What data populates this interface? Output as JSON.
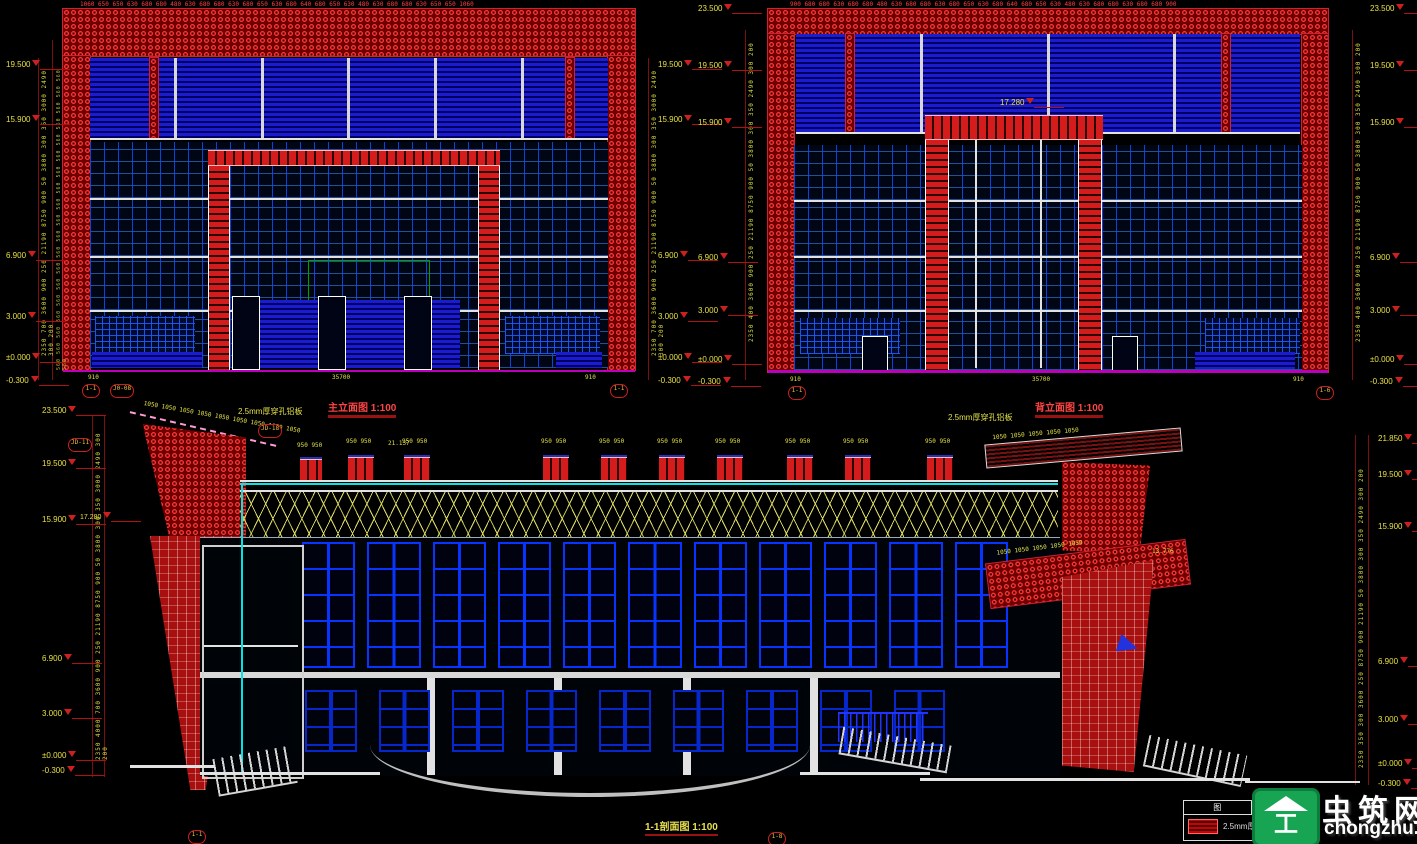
{
  "colors": {
    "background": "#000000",
    "cad_red": "#d41c1c",
    "cad_blue": "#1b1bd0",
    "window_blue": "#0735ff",
    "dim_red": "#ff4040",
    "dim_yellow": "#e0e048",
    "cyan": "#00e5e5",
    "magenta_base": "#bb00bb",
    "truss_yellow": "#d8d860",
    "watermark_green": "#17a554"
  },
  "titles": {
    "front_elevation": "主立面图",
    "front_scale": "1:100",
    "rear_elevation": "背立面图",
    "rear_scale": "1:100",
    "section": "1-1剖面图",
    "section_scale": "1:100"
  },
  "notes": {
    "perforated_panel": "2.5mm厚穿孔铝板"
  },
  "front_elev": {
    "top_dims": "1060 650 650 630 680 680 480 630 680 680 630 680 650 630 680 640 680 650 630 480 630 680 680 630 650 650 1060",
    "side_dims": "2350 700 3600 900 250 21190 8750 900 50 3800 300 350 3000 2490 300 200",
    "side_small_dims": "560 560 560 560 560 560 560 560 560 560 560 560 560 560 560 560 560 560 560 560",
    "levels": [
      "19.500",
      "15.900",
      "6.900",
      "3.000",
      "±0.000",
      "-0.300"
    ],
    "bottom_left": "910",
    "bottom_mid": "35700",
    "bottom_right": "910",
    "axis_a": "1-1",
    "axis_b": "1-1",
    "detail_a": "J0-08"
  },
  "rear_elev": {
    "top_dims": "900 680 680 630 680 680 480 630 680 680 630 680 650 630 680 640 680 650 630 480 630 680 680 630 680 680 900",
    "side_dims": "2350 400 3600 900 250 21190 8750 900 50 3800 300 350 2490 300 200",
    "levels": [
      "23.500",
      "19.500",
      "15.900",
      "6.900",
      "3.000",
      "±0.000",
      "-0.300"
    ],
    "mid_level": "17.280",
    "bottom_left": "910",
    "bottom_mid": "35700",
    "bottom_right": "910",
    "axis_a": "1-1",
    "axis_b": "1-6"
  },
  "section": {
    "levels_left": [
      "23.500",
      "19.500",
      "15.900",
      "6.900",
      "3.000",
      "±0.000",
      "-0.300"
    ],
    "levels_right": [
      "21.850",
      "19.500",
      "15.900",
      "6.900",
      "3.000",
      "±0.000",
      "-0.300"
    ],
    "side_dims_left": "2350 4000 700 3600 900 250 21190 8750 900 50 3800 300 350 3000 2490 300 200",
    "side_dims_right": "2350 350 300 3600 250 8750 900 21190 50 3800 300 350 2490 300 200",
    "slope_dims": "1050 1050 1050 1050 1050 1050 1050 1050 1050",
    "slope_dims2": "1050 1050 1050 1050 1050",
    "monitor_dim": "950 950",
    "mark_17280": "17.280",
    "mark_13776": "13.776",
    "mark_21137": "21.137",
    "detail_a": "JD-18",
    "detail_b": "JD-11",
    "axis_a": "1-1",
    "axis_b": "1-8"
  },
  "legend": {
    "header_left": "图",
    "header_right": "例",
    "item_label": "2.5mm厚穿孔铝板"
  },
  "watermark": {
    "site_name": "虫筑网",
    "site_url": "chongzhu.cn",
    "logo_glyph": "工"
  }
}
